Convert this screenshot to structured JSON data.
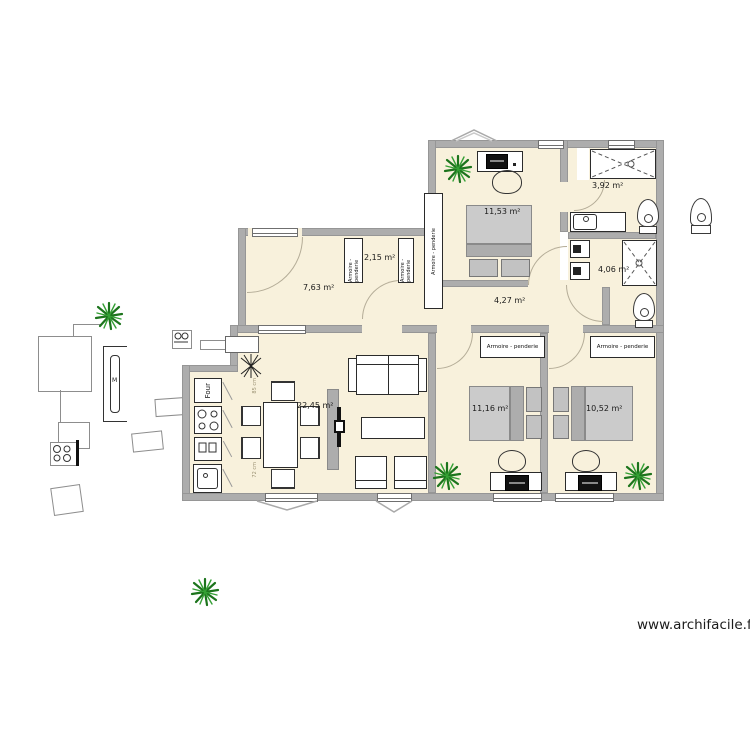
{
  "watermark": "www.archifacile.fr",
  "colors": {
    "wall": "#adadad",
    "floor": "#f8f1dc",
    "plant_dark": "#1c741c",
    "plant_light": "#35a035",
    "bed_mattress": "#cbcbcb",
    "bed_fold": "#adadad",
    "door_arc": "#b4ac97"
  },
  "rooms": {
    "bedroom_top": {
      "area": "11,53 m²"
    },
    "shower_room": {
      "area": "3,92 m²"
    },
    "closet": {
      "area": "2,15 m²"
    },
    "entry": {
      "area": "7,63 m²"
    },
    "bathroom": {
      "area": "4,06 m²"
    },
    "hallway": {
      "area": "4,27 m²"
    },
    "living": {
      "area": "22,45 m²"
    },
    "bedroom_left": {
      "area": "11,16 m²"
    },
    "bedroom_right": {
      "area": "10,52 m²"
    }
  },
  "labels": {
    "wardrobe": "Armoire - penderie",
    "oven": "Four",
    "radiator": "M",
    "dim_top": "85 cm",
    "dim_bottom": "72 cm"
  }
}
